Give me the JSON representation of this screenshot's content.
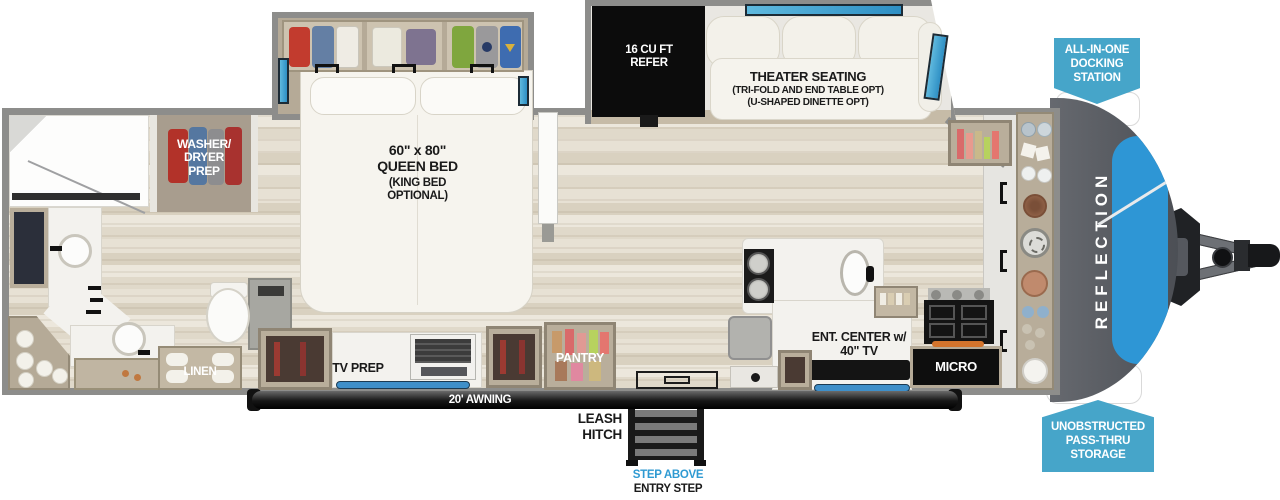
{
  "colors": {
    "badge_blue": "#46a5c9",
    "accent_blue": "#2e96d5",
    "step_above_blue": "#2f9ad2",
    "wall_gray": "#8d8d8b"
  },
  "badges": {
    "docking": {
      "lines": [
        "ALL-IN-ONE",
        "DOCKING",
        "STATION"
      ]
    },
    "passthru": {
      "lines": [
        "UNOBSTRUCTED",
        "PASS-THRU",
        "STORAGE"
      ]
    }
  },
  "labels": {
    "washer_dryer": {
      "lines": [
        "WASHER/",
        "DRYER",
        "PREP"
      ]
    },
    "queen_bed": {
      "lines": [
        "60\" x 80\"",
        "QUEEN BED",
        "(KING BED",
        "OPTIONAL)"
      ]
    },
    "refer": {
      "lines": [
        "16 CU FT",
        "REFER"
      ]
    },
    "theater": {
      "lines": [
        "THEATER SEATING",
        "(TRI-FOLD AND END TABLE OPT)",
        "(U-SHAPED DINETTE OPT)"
      ]
    },
    "linen": "LINEN",
    "tv_prep": "TV PREP",
    "pantry": "PANTRY",
    "awning": "20' AWNING",
    "leash_hitch": {
      "lines": [
        "LEASH",
        "HITCH"
      ]
    },
    "entry_step": {
      "line1": "STEP ABOVE",
      "line2": "ENTRY STEP"
    },
    "ent_center": {
      "lines": [
        "ENT. CENTER w/",
        "40\" TV"
      ]
    },
    "micro": "MICRO"
  },
  "brand": {
    "name": "REFLECTION"
  }
}
